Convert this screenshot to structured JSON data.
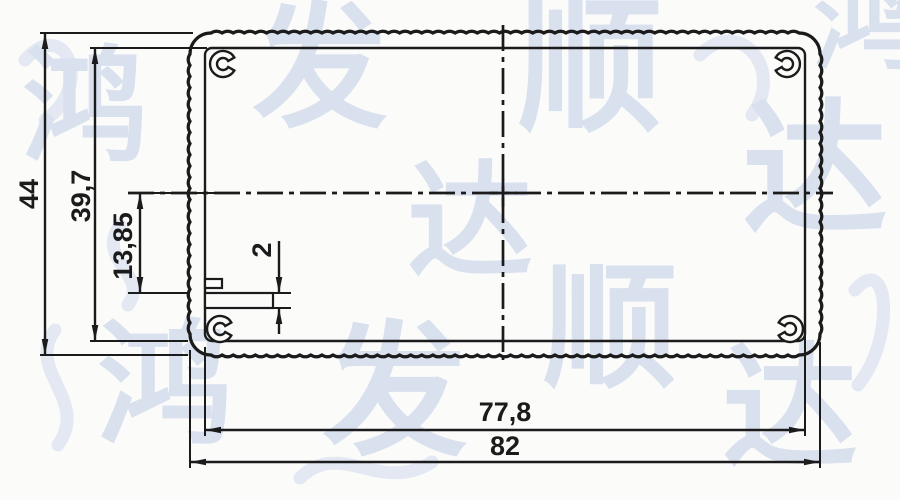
{
  "drawing": {
    "dimensions": {
      "overall_height": "44",
      "inner_height": "39,7",
      "slot_offset": "13,85",
      "slot_thickness": "2",
      "inner_width": "77,8",
      "overall_width": "82"
    },
    "watermark": {
      "text": "鸿发顺达",
      "items": [
        {
          "ch": "鸿",
          "x": 85,
          "y": 150,
          "size": 125
        },
        {
          "ch": "发",
          "x": 320,
          "y": 115,
          "size": 135
        },
        {
          "ch": "顺",
          "x": 590,
          "y": 118,
          "size": 145
        },
        {
          "ch": "达",
          "x": 815,
          "y": 220,
          "size": 145
        },
        {
          "ch": "达",
          "x": 470,
          "y": 265,
          "size": 125
        },
        {
          "ch": "顺",
          "x": 610,
          "y": 375,
          "size": 135
        },
        {
          "ch": "鸿",
          "x": 165,
          "y": 432,
          "size": 135
        },
        {
          "ch": "发",
          "x": 395,
          "y": 442,
          "size": 145
        },
        {
          "ch": "达",
          "x": 790,
          "y": 455,
          "size": 135
        },
        {
          "ch": "鸿",
          "x": 866,
          "y": 60,
          "size": 105
        }
      ]
    },
    "colors": {
      "line": "#1b1b1b",
      "watermark": "#bfcae6",
      "background": "#fbfbfa"
    }
  }
}
